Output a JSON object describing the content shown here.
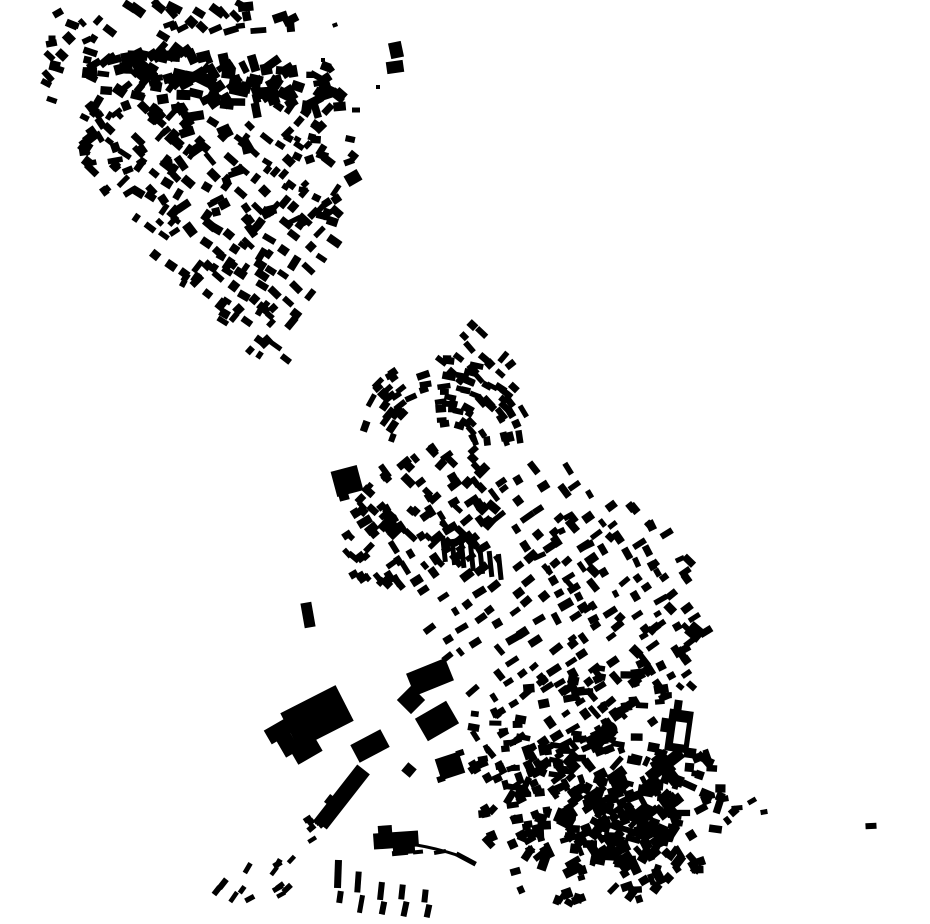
{
  "map": {
    "canvas": {
      "width": 930,
      "height": 924,
      "background": "#ffffff",
      "ink": "#000000"
    },
    "generators": {
      "scatters": [
        {
          "name": "nw-top-band",
          "seed": 11,
          "cx": 235,
          "cy": 82,
          "rx": 115,
          "ry": 26,
          "rot": 9,
          "count": 95,
          "w": [
            9,
            20
          ],
          "h": [
            6,
            12
          ],
          "angles": [
            0,
            -40,
            70,
            20
          ],
          "jitter": 15
        },
        {
          "name": "nw-topleft",
          "seed": 12,
          "cx": 112,
          "cy": 72,
          "rx": 70,
          "ry": 58,
          "rot": 0,
          "count": 50,
          "w": [
            7,
            15
          ],
          "h": [
            5,
            10
          ],
          "angles": [
            -40,
            30,
            0
          ],
          "jitter": 20
        },
        {
          "name": "nw-mid",
          "seed": 13,
          "cx": 170,
          "cy": 165,
          "rx": 115,
          "ry": 62,
          "rot": 25,
          "count": 85,
          "w": [
            7,
            16
          ],
          "h": [
            5,
            10
          ],
          "angles": [
            -42,
            48,
            -20
          ],
          "jitter": 12
        },
        {
          "name": "nw-right-edge",
          "seed": 14,
          "cx": 315,
          "cy": 150,
          "rx": 42,
          "ry": 85,
          "rot": 5,
          "count": 36,
          "w": [
            6,
            13
          ],
          "h": [
            5,
            9
          ],
          "angles": [
            -35,
            20
          ],
          "jitter": 20
        },
        {
          "name": "nw-top-row",
          "seed": 24,
          "cx": 215,
          "cy": 16,
          "rx": 95,
          "ry": 15,
          "rot": 3,
          "count": 25,
          "w": [
            7,
            16
          ],
          "h": [
            5,
            10
          ],
          "angles": [
            -15,
            40
          ],
          "jitter": 15
        },
        {
          "name": "nw-tail-fill",
          "seed": 25,
          "cx": 237,
          "cy": 300,
          "rx": 58,
          "ry": 60,
          "rot": -40,
          "count": 28,
          "w": [
            7,
            14
          ],
          "h": [
            5,
            9
          ],
          "angles": [
            38,
            -52
          ],
          "jitter": 10
        },
        {
          "name": "c-west-wing",
          "seed": 15,
          "cx": 420,
          "cy": 515,
          "rx": 92,
          "ry": 58,
          "rot": -35,
          "count": 100,
          "w": [
            7,
            15
          ],
          "h": [
            5,
            9
          ],
          "angles": [
            -40,
            50
          ],
          "jitter": 10
        },
        {
          "name": "c-east-edge",
          "seed": 16,
          "cx": 618,
          "cy": 592,
          "rx": 80,
          "ry": 95,
          "rot": -30,
          "count": 50,
          "w": [
            6,
            13
          ],
          "h": [
            5,
            9
          ],
          "angles": [
            -35,
            55
          ],
          "jitter": 12
        },
        {
          "name": "c-south-band",
          "seed": 17,
          "cx": 560,
          "cy": 722,
          "rx": 112,
          "ry": 48,
          "rot": -18,
          "count": 85,
          "w": [
            7,
            15
          ],
          "h": [
            5,
            9
          ],
          "angles": [
            -30,
            60,
            0
          ],
          "jitter": 12
        },
        {
          "name": "s-village-outer",
          "seed": 18,
          "cx": 612,
          "cy": 822,
          "rx": 128,
          "ry": 82,
          "rot": -12,
          "count": 170,
          "w": [
            6,
            16
          ],
          "h": [
            5,
            10
          ],
          "angles": [
            -30,
            60,
            10,
            -60
          ],
          "jitter": 15
        },
        {
          "name": "s-village-core",
          "seed": 19,
          "cx": 622,
          "cy": 818,
          "rx": 62,
          "ry": 46,
          "rot": -15,
          "count": 110,
          "w": [
            7,
            18
          ],
          "h": [
            5,
            11
          ],
          "angles": [
            -30,
            60,
            15
          ],
          "jitter": 15
        },
        {
          "name": "s-village-west",
          "seed": 23,
          "cx": 520,
          "cy": 790,
          "rx": 48,
          "ry": 52,
          "rot": 10,
          "count": 38,
          "w": [
            6,
            13
          ],
          "h": [
            5,
            9
          ],
          "angles": [
            -20,
            65,
            0
          ],
          "jitter": 15
        },
        {
          "name": "sw-dashes",
          "seed": 20,
          "cx": 253,
          "cy": 886,
          "rx": 50,
          "ry": 26,
          "rot": -22,
          "count": 14,
          "w": [
            8,
            12
          ],
          "h": [
            4,
            6
          ],
          "angles": [
            -45
          ],
          "jitter": 18
        },
        {
          "name": "ind-dash-row",
          "seed": 21,
          "cx": 315,
          "cy": 827,
          "rx": 26,
          "ry": 12,
          "rot": -35,
          "count": 8,
          "w": [
            7,
            10
          ],
          "h": [
            4,
            6
          ],
          "angles": [
            -38
          ],
          "jitter": 10
        },
        {
          "name": "ne-corner-small",
          "seed": 22,
          "cx": 682,
          "cy": 676,
          "rx": 17,
          "ry": 30,
          "rot": 0,
          "count": 8,
          "w": [
            7,
            11
          ],
          "h": [
            5,
            8
          ],
          "angles": [
            -30,
            50
          ],
          "jitter": 10
        }
      ],
      "rows": [
        {
          "name": "nw-tail-rows",
          "seed": 31,
          "ox": 60,
          "oy": 180,
          "u": [
            0.79,
            0.61
          ],
          "v": [
            0.61,
            -0.79
          ],
          "nRows": 13,
          "rowSpacing": 20,
          "nCells": 18,
          "cellSpacing": 17,
          "skip": 0.25,
          "w": [
            8,
            15
          ],
          "h": [
            5,
            9
          ],
          "ang": 38,
          "angJitter": 8,
          "perpProb": 0.25,
          "posJitter": 4,
          "mask": [
            [
              82,
              140
            ],
            [
              340,
              94
            ],
            [
              338,
              242
            ],
            [
              268,
              402
            ],
            [
              168,
              276
            ]
          ]
        },
        {
          "name": "c-main-grid",
          "seed": 32,
          "ox": 330,
          "oy": 545,
          "u": [
            0.82,
            -0.57
          ],
          "v": [
            0.57,
            0.82
          ],
          "nRows": 21,
          "rowSpacing": 18,
          "nCells": 28,
          "cellSpacing": 16,
          "skip": 0.3,
          "w": [
            8,
            15
          ],
          "h": [
            5,
            9
          ],
          "ang": -35,
          "angJitter": 6,
          "perpProb": 0.3,
          "posJitter": 4,
          "mask": [
            [
              388,
              560
            ],
            [
              495,
              468
            ],
            [
              560,
              452
            ],
            [
              650,
              540
            ],
            [
              714,
              636
            ],
            [
              652,
              702
            ],
            [
              584,
              760
            ],
            [
              524,
              764
            ],
            [
              466,
              688
            ],
            [
              418,
              640
            ]
          ]
        },
        {
          "name": "c-arch-ne-rows",
          "seed": 33,
          "ox": 440,
          "oy": 360,
          "u": [
            0.72,
            0.69
          ],
          "v": [
            0.69,
            -0.72
          ],
          "nRows": 4,
          "rowSpacing": 16,
          "nCells": 6,
          "cellSpacing": 14,
          "skip": 0.25,
          "w": [
            8,
            13
          ],
          "h": [
            5,
            8
          ],
          "ang": 45,
          "angJitter": 8,
          "perpProb": 0.2,
          "posJitter": 3
        }
      ],
      "arcs": [
        {
          "name": "c-arch-outer",
          "seed": 41,
          "cx": 445,
          "cy": 455,
          "r": [
            55,
            100
          ],
          "deg": [
            195,
            350
          ],
          "count": 55,
          "w": [
            8,
            14
          ],
          "h": [
            5,
            8
          ],
          "jitter": 8
        },
        {
          "name": "c-arch-inner",
          "seed": 42,
          "cx": 447,
          "cy": 452,
          "r": [
            28,
            52
          ],
          "deg": [
            255,
            345
          ],
          "count": 18,
          "w": [
            7,
            12
          ],
          "h": [
            5,
            8
          ],
          "jitter": 10
        }
      ],
      "bar_rows": [
        {
          "name": "terrace-bars",
          "x0": 444,
          "y0": 549,
          "n": 7,
          "dx": 9.3,
          "dy": 3,
          "w": 5,
          "h": 26,
          "ang": -6
        }
      ]
    },
    "explicit": {
      "rects": [
        [
          317,
          717,
          62,
          40,
          -27
        ],
        [
          279,
          731,
          26,
          16,
          -30
        ],
        [
          288,
          745,
          16,
          20,
          -30
        ],
        [
          306,
          750,
          28,
          18,
          -30
        ],
        [
          370,
          746,
          34,
          20,
          -28
        ],
        [
          342,
          797,
          16,
          70,
          38
        ],
        [
          331,
          801,
          10,
          10,
          38
        ],
        [
          430,
          677,
          42,
          24,
          -22
        ],
        [
          411,
          700,
          20,
          20,
          45
        ],
        [
          437,
          721,
          36,
          26,
          -30
        ],
        [
          450,
          766,
          25,
          22,
          -18
        ],
        [
          441,
          779,
          8,
          6,
          -18
        ],
        [
          460,
          753,
          8,
          6,
          -18
        ],
        [
          409,
          770,
          11,
          11,
          40
        ],
        [
          396,
          840,
          45,
          16,
          -4
        ],
        [
          385,
          830,
          14,
          9,
          -4
        ],
        [
          404,
          850,
          22,
          8,
          -4
        ],
        [
          347,
          481,
          27,
          26,
          -15
        ],
        [
          344,
          497,
          10,
          7,
          -15
        ],
        [
          308,
          615,
          11,
          25,
          -10
        ],
        [
          353,
          178,
          15,
          12,
          -30
        ],
        [
          396,
          50,
          13,
          16,
          -12
        ],
        [
          395,
          67,
          17,
          12,
          -8
        ],
        [
          356,
          110,
          8,
          5,
          0
        ],
        [
          378,
          87,
          4,
          4,
          0
        ],
        [
          679,
          731,
          24,
          42,
          8
        ],
        [
          665,
          725,
          8,
          14,
          8
        ],
        [
          678,
          706,
          8,
          12,
          8
        ],
        [
          690,
          753,
          12,
          10,
          8
        ],
        [
          665,
          765,
          42,
          12,
          -38
        ],
        [
          666,
          769,
          12,
          34,
          -38
        ],
        [
          723,
          799,
          11,
          6,
          -10
        ],
        [
          737,
          808,
          11,
          5,
          -5
        ],
        [
          752,
          801,
          9,
          5,
          -30
        ],
        [
          764,
          812,
          7,
          5,
          -10
        ],
        [
          712,
          796,
          6,
          5,
          -10
        ],
        [
          871,
          826,
          11,
          6,
          -3
        ],
        [
          338,
          874,
          7,
          28,
          2
        ],
        [
          340,
          897,
          6,
          12,
          8
        ],
        [
          358,
          882,
          6,
          21,
          4
        ],
        [
          361,
          904,
          5,
          18,
          10
        ],
        [
          381,
          891,
          6,
          18,
          6
        ],
        [
          383,
          908,
          6,
          13,
          11
        ],
        [
          402,
          892,
          6,
          15,
          6
        ],
        [
          405,
          909,
          6,
          15,
          12
        ],
        [
          425,
          896,
          6,
          13,
          6
        ],
        [
          428,
          911,
          6,
          13,
          12
        ],
        [
          400,
          853,
          16,
          5,
          -5
        ],
        [
          418,
          852,
          10,
          4,
          -6
        ],
        [
          440,
          852,
          12,
          4,
          -10
        ],
        [
          466,
          859,
          22,
          5,
          28
        ],
        [
          695,
          632,
          16,
          15,
          40
        ],
        [
          58,
          13,
          10,
          7,
          -30
        ],
        [
          75,
          25,
          8,
          6,
          20
        ],
        [
          52,
          38,
          7,
          5,
          0
        ],
        [
          335,
          25,
          5,
          4,
          -20
        ],
        [
          323,
          60,
          4,
          4,
          0
        ]
      ],
      "circles": [
        [
          609,
          730,
          8.5
        ]
      ],
      "courtyards": [
        [
          680,
          733,
          11,
          22,
          8
        ]
      ],
      "paths": [
        {
          "d": "M 378 841 Q 426 843 468 859",
          "width": 3
        }
      ]
    }
  }
}
